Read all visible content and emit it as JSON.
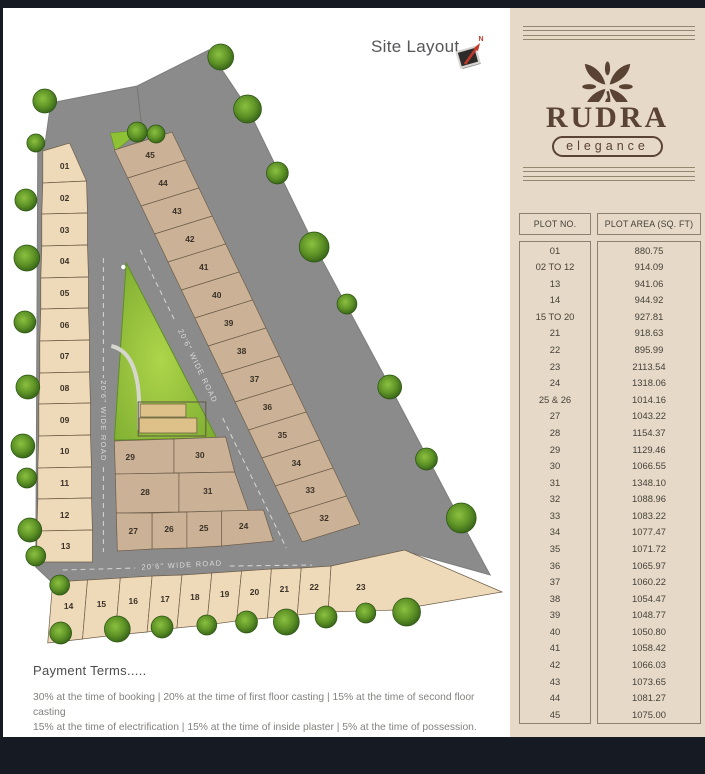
{
  "page": {
    "site_layout_title": "Site Layout",
    "compass_label": "N"
  },
  "brand": {
    "name": "RUDRA",
    "tagline": "elegance"
  },
  "plot_table": {
    "col_plot_no": "PLOT NO.",
    "col_plot_area": "PLOT AREA (SQ. FT)",
    "rows": [
      [
        "01",
        "880.75"
      ],
      [
        "02 TO 12",
        "914.09"
      ],
      [
        "13",
        "941.06"
      ],
      [
        "14",
        "944.92"
      ],
      [
        "15 TO 20",
        "927.81"
      ],
      [
        "21",
        "918.63"
      ],
      [
        "22",
        "895.99"
      ],
      [
        "23",
        "2113.54"
      ],
      [
        "24",
        "1318.06"
      ],
      [
        "25 & 26",
        "1014.16"
      ],
      [
        "27",
        "1043.22"
      ],
      [
        "28",
        "1154.37"
      ],
      [
        "29",
        "1129.46"
      ],
      [
        "30",
        "1066.55"
      ],
      [
        "31",
        "1348.10"
      ],
      [
        "32",
        "1088.96"
      ],
      [
        "33",
        "1083.22"
      ],
      [
        "34",
        "1077.47"
      ],
      [
        "35",
        "1071.72"
      ],
      [
        "36",
        "1065.97"
      ],
      [
        "37",
        "1060.22"
      ],
      [
        "38",
        "1054.47"
      ],
      [
        "39",
        "1048.77"
      ],
      [
        "40",
        "1050.80"
      ],
      [
        "41",
        "1058.42"
      ],
      [
        "42",
        "1066.03"
      ],
      [
        "43",
        "1073.65"
      ],
      [
        "44",
        "1081.27"
      ],
      [
        "45",
        "1075.00"
      ]
    ]
  },
  "payment_terms": {
    "heading": "Payment Terms.....",
    "line1": "30% at the time of booking  |  20% at the time of first floor casting  |  15% at the time of second floor casting",
    "line2": "15% at the time of electrification  |  15% at the time of inside plaster  |  5% at the time of possession."
  },
  "site": {
    "road_label": "20'6\" WIDE ROAD",
    "plots": [
      {
        "no": "01",
        "points": "40,151 67,143 84,181 40,183",
        "lx": 62,
        "ly": 166,
        "tone": "light"
      },
      {
        "no": "02",
        "points": "40,183 84,181 85,213 39,214",
        "lx": 62,
        "ly": 198,
        "tone": "light"
      },
      {
        "no": "03",
        "points": "39,214 85,213 85,245 39,246",
        "lx": 62,
        "ly": 230,
        "tone": "light"
      },
      {
        "no": "04",
        "points": "39,246 85,245 86,277 38,278",
        "lx": 62,
        "ly": 261,
        "tone": "light"
      },
      {
        "no": "05",
        "points": "38,278 86,277 86,308 38,309",
        "lx": 62,
        "ly": 293,
        "tone": "light"
      },
      {
        "no": "06",
        "points": "38,309 86,308 87,340 37,341",
        "lx": 62,
        "ly": 325,
        "tone": "light"
      },
      {
        "no": "07",
        "points": "37,341 87,340 87,372 37,373",
        "lx": 62,
        "ly": 356,
        "tone": "light"
      },
      {
        "no": "08",
        "points": "37,373 87,372 88,403 36,404",
        "lx": 62,
        "ly": 388,
        "tone": "light"
      },
      {
        "no": "09",
        "points": "36,404 88,403 88,435 36,436",
        "lx": 62,
        "ly": 420,
        "tone": "light"
      },
      {
        "no": "10",
        "points": "36,436 88,435 89,467 35,468",
        "lx": 62,
        "ly": 451,
        "tone": "light"
      },
      {
        "no": "11",
        "points": "35,468 89,467 89,498 35,499",
        "lx": 62,
        "ly": 483,
        "tone": "light"
      },
      {
        "no": "12",
        "points": "35,499 89,498 90,530 34,531",
        "lx": 62,
        "ly": 515,
        "tone": "light"
      },
      {
        "no": "13",
        "points": "34,531 90,530 90,562 34,562",
        "lx": 63,
        "ly": 546,
        "tone": "light"
      },
      {
        "no": "45",
        "points": "112,150 170,132 183.5,160 125.5,178",
        "lx": 148,
        "ly": 155,
        "tone": "dark"
      },
      {
        "no": "44",
        "points": "125.5,178 183.5,160 197,188 139,206",
        "lx": 161,
        "ly": 183,
        "tone": "dark"
      },
      {
        "no": "43",
        "points": "139,206 197,188 210.5,216 152.5,234",
        "lx": 175,
        "ly": 211,
        "tone": "dark"
      },
      {
        "no": "42",
        "points": "152.5,234 210.5,216 224,244 166,262",
        "lx": 188,
        "ly": 239,
        "tone": "dark"
      },
      {
        "no": "41",
        "points": "166,262 224,244 237.5,272 179.5,290",
        "lx": 202,
        "ly": 267,
        "tone": "dark"
      },
      {
        "no": "40",
        "points": "179.5,290 237.5,272 251,300 193,318",
        "lx": 215,
        "ly": 295,
        "tone": "dark"
      },
      {
        "no": "39",
        "points": "193,318 251,300 264.5,328 206.5,346",
        "lx": 227,
        "ly": 323,
        "tone": "dark"
      },
      {
        "no": "38",
        "points": "206.5,346 264.5,328 278,356 220,374",
        "lx": 240,
        "ly": 351,
        "tone": "dark"
      },
      {
        "no": "37",
        "points": "220,374 278,356 291.5,384 233.5,402",
        "lx": 253,
        "ly": 379,
        "tone": "dark"
      },
      {
        "no": "36",
        "points": "233.5,402 291.5,384 305,412 247,430",
        "lx": 266,
        "ly": 407,
        "tone": "dark"
      },
      {
        "no": "35",
        "points": "247,430 305,412 318.5,440 260.5,458",
        "lx": 281,
        "ly": 435,
        "tone": "dark"
      },
      {
        "no": "34",
        "points": "260.5,458 318.5,440 332,468 274,486",
        "lx": 295,
        "ly": 463,
        "tone": "dark"
      },
      {
        "no": "33",
        "points": "274,486 332,468 345.5,496 287.5,514",
        "lx": 309,
        "ly": 490,
        "tone": "dark"
      },
      {
        "no": "32",
        "points": "287.5,514 345.5,496 359,524 301,542",
        "lx": 323,
        "ly": 518,
        "tone": "dark"
      },
      {
        "no": "29",
        "points": "112,441 172,439 172,473 113,474",
        "lx": 128,
        "ly": 457,
        "tone": "dark"
      },
      {
        "no": "30",
        "points": "172,439 224,437 233,472 172,473",
        "lx": 198,
        "ly": 455,
        "tone": "dark"
      },
      {
        "no": "28",
        "points": "113,474 177,473 177,512 114,513",
        "lx": 143,
        "ly": 492,
        "tone": "dark"
      },
      {
        "no": "31",
        "points": "177,473 233,472 247,511 177,512",
        "lx": 206,
        "ly": 491,
        "tone": "dark"
      },
      {
        "no": "27",
        "points": "114,513 150,513 150,549 115,551",
        "lx": 131,
        "ly": 531,
        "tone": "dark"
      },
      {
        "no": "26",
        "points": "150,513 185,512 185,548 150,549",
        "lx": 167,
        "ly": 529,
        "tone": "dark"
      },
      {
        "no": "25",
        "points": "185,512 220,511 220,546 185,548",
        "lx": 202,
        "ly": 528,
        "tone": "dark"
      },
      {
        "no": "24",
        "points": "220,511 262,510 272,541 220,546",
        "lx": 242,
        "ly": 526,
        "tone": "dark"
      },
      {
        "no": "14",
        "points": "50,582 85,580 80,639 45,643",
        "lx": 66,
        "ly": 606,
        "tone": "light"
      },
      {
        "no": "15",
        "points": "85,580 118,578 113,635 80,639",
        "lx": 99,
        "ly": 604,
        "tone": "light"
      },
      {
        "no": "16",
        "points": "118,578 150,576 145,632 113,635",
        "lx": 131,
        "ly": 601,
        "tone": "light"
      },
      {
        "no": "17",
        "points": "150,576 180,575 175,628 145,632",
        "lx": 163,
        "ly": 599,
        "tone": "light"
      },
      {
        "no": "18",
        "points": "180,575 210,573 205,625 175,628",
        "lx": 193,
        "ly": 597,
        "tone": "light"
      },
      {
        "no": "19",
        "points": "210,573 240,571 235,621 205,625",
        "lx": 223,
        "ly": 594,
        "tone": "light"
      },
      {
        "no": "20",
        "points": "240,571 270,569 266,618 235,621",
        "lx": 253,
        "ly": 592,
        "tone": "light"
      },
      {
        "no": "21",
        "points": "270,569 300,568 296,615 266,618",
        "lx": 283,
        "ly": 589,
        "tone": "light"
      },
      {
        "no": "22",
        "points": "300,568 330,566 327,612 296,615",
        "lx": 313,
        "ly": 587,
        "tone": "light"
      },
      {
        "no": "23",
        "points": "330,566 404,550 502,592 396,610 327,612",
        "lx": 360,
        "ly": 587,
        "tone": "light"
      }
    ],
    "trees": [
      [
        33,
        143,
        9
      ],
      [
        23,
        200,
        11
      ],
      [
        24,
        258,
        13
      ],
      [
        22,
        322,
        11
      ],
      [
        25,
        387,
        12
      ],
      [
        20,
        446,
        12
      ],
      [
        24,
        478,
        10
      ],
      [
        27,
        530,
        12
      ],
      [
        33,
        556,
        10
      ],
      [
        57,
        585,
        10
      ],
      [
        42,
        101,
        12
      ],
      [
        135,
        132,
        10
      ],
      [
        154,
        134,
        9
      ],
      [
        219,
        57,
        13
      ],
      [
        246,
        109,
        14
      ],
      [
        276,
        173,
        11
      ],
      [
        313,
        247,
        15
      ],
      [
        346,
        304,
        10
      ],
      [
        389,
        387,
        12
      ],
      [
        426,
        459,
        11
      ],
      [
        461,
        518,
        15
      ],
      [
        58,
        633,
        11
      ],
      [
        115,
        629,
        13
      ],
      [
        160,
        627,
        11
      ],
      [
        205,
        625,
        10
      ],
      [
        245,
        622,
        11
      ],
      [
        285,
        622,
        13
      ],
      [
        325,
        617,
        11
      ],
      [
        365,
        613,
        10
      ],
      [
        406,
        612,
        14
      ]
    ]
  },
  "colors": {
    "panel_bg": "#e6d9c7",
    "brand_brown": "#5b4334",
    "land_gray": "#8b8b8b",
    "plot_light": "#eed9b8",
    "plot_dark": "#cbb296",
    "park_green": "#8fc135",
    "compass_red": "#c0392b",
    "letterbox": "#161b23"
  }
}
